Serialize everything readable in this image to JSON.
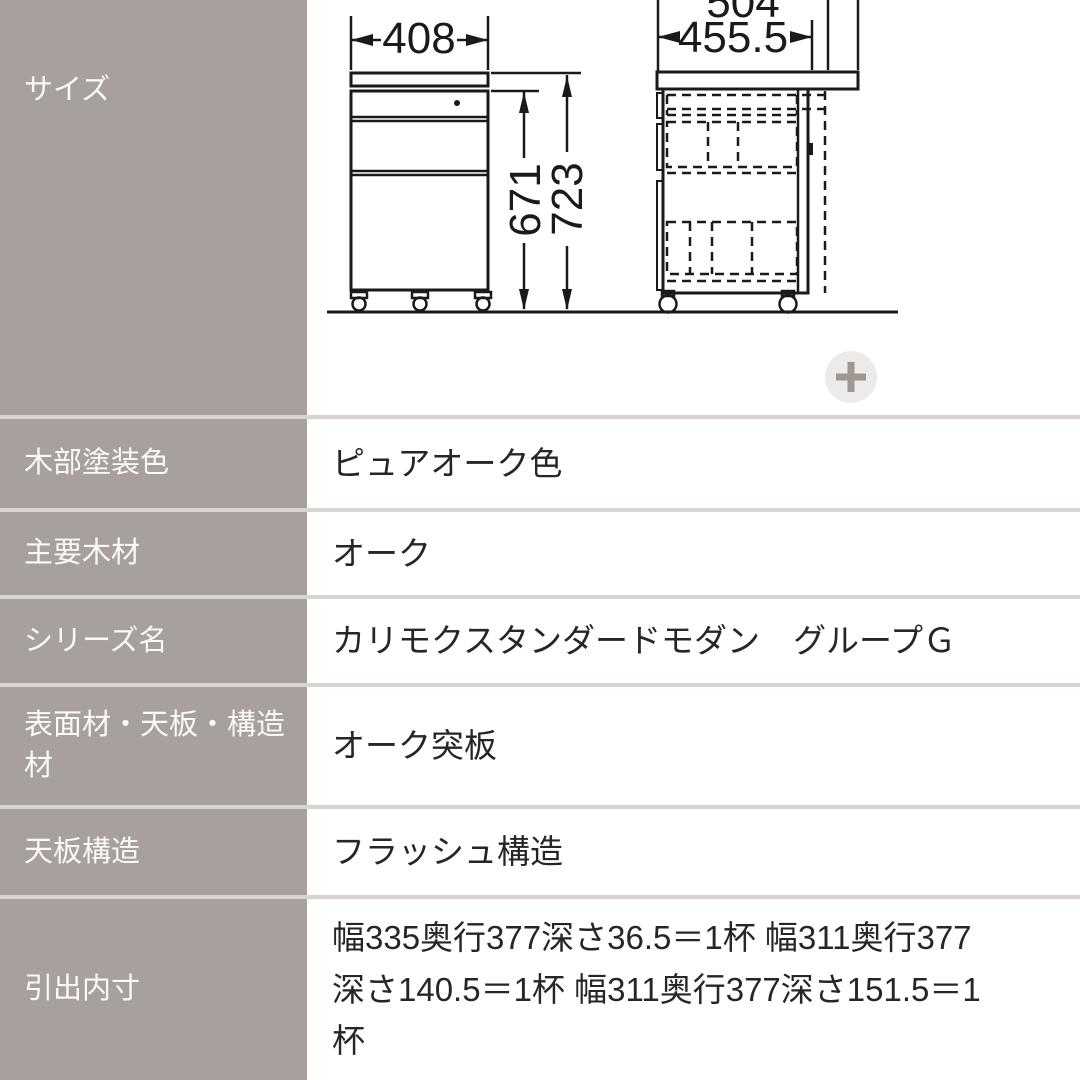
{
  "spec_table": {
    "rows": [
      {
        "label": "サイズ",
        "value": ""
      },
      {
        "label": "木部塗装色",
        "value": "ピュアオーク色"
      },
      {
        "label": "主要木材",
        "value": "オーク"
      },
      {
        "label": "シリーズ名",
        "value": "カリモクスタンダードモダン　グループＧ"
      },
      {
        "label": "表面材・天板・構造材",
        "value": "オーク突板"
      },
      {
        "label": "天板構造",
        "value": "フラッシュ構造"
      },
      {
        "label": "引出内寸",
        "value": "幅335奥行377深さ36.5＝1杯 幅311奥行377深さ140.5＝1杯 幅311奥行377深さ151.5＝1杯"
      }
    ]
  },
  "diagram": {
    "front_view": {
      "width_mm": "408",
      "height_body_mm": "671",
      "height_total_mm": "723"
    },
    "side_view": {
      "depth_overall_mm": "504",
      "depth_body_mm": "455.5"
    }
  },
  "zoom_button": {
    "icon": "plus"
  },
  "colors": {
    "label_bg": "#a8a09c",
    "label_text": "#fbfaf9",
    "separator": "#d8d4d2",
    "value_text": "#262626",
    "diagram_line": "#1a1a1a",
    "zoom_button_bg": "#ecebea",
    "zoom_button_icon": "#9d9691"
  }
}
